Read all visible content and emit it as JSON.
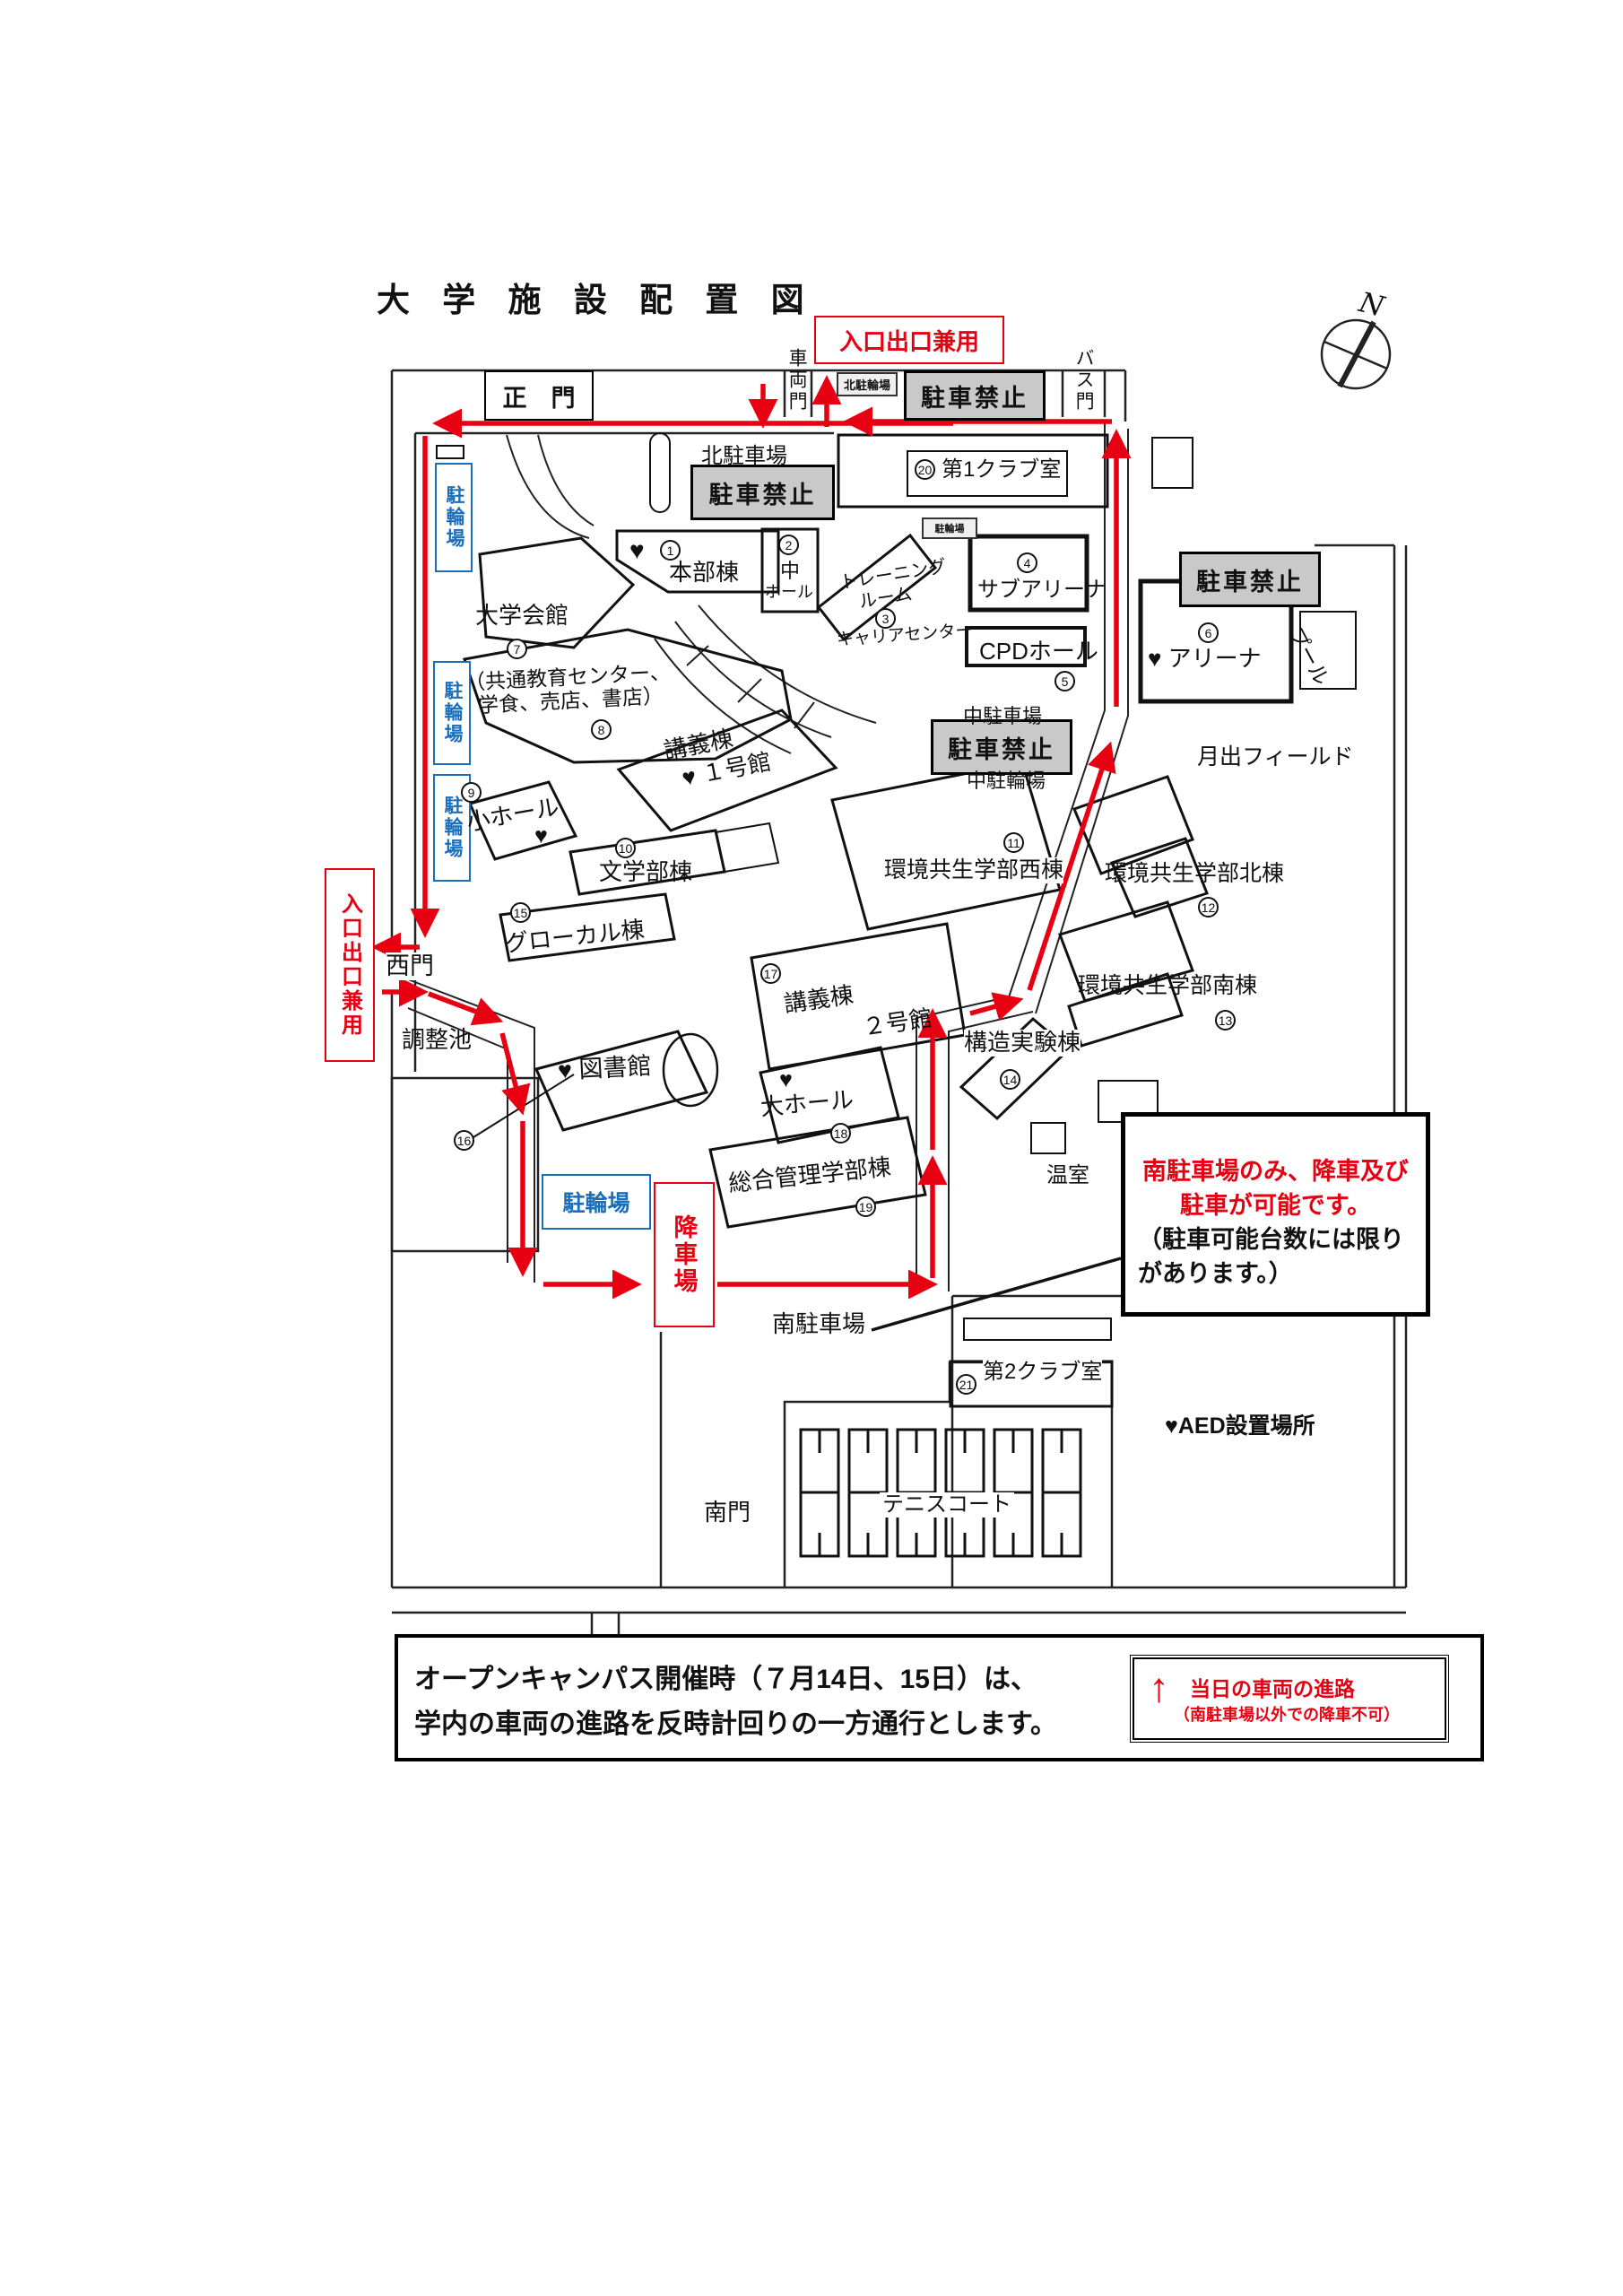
{
  "title": "大 学 施 設 配 置 図",
  "compass_label": "N",
  "gates": {
    "main": "正　門",
    "vehicle": "車両門",
    "bus": "バス門",
    "west": "西門",
    "south": "南門"
  },
  "signs": {
    "no_parking": "駐車禁止",
    "entry_exit": "入口出口兼用",
    "bike": "駐輪場",
    "bike_north": "北駐輪場",
    "drop_off": "降車場"
  },
  "areas": {
    "north_parking": "北駐車場",
    "mid_parking": "中駐車場",
    "mid_bike": "中駐輪場",
    "south_parking": "南駐車場",
    "tsukide_field": "月出フィールド",
    "pond": "調整池",
    "tennis": "テニスコート",
    "greenhouse": "温室",
    "pool": "プール"
  },
  "buildings": {
    "honbu": {
      "num": "1",
      "name": "本部棟",
      "heart": "♥"
    },
    "naka_hall": {
      "num": "2",
      "name_top": "中",
      "name_bottom": "ホール"
    },
    "training": {
      "num": "3",
      "line1": "トレーニング",
      "line2": "ルーム"
    },
    "sub_arena": {
      "num": "4",
      "name": "サブアリーナ"
    },
    "cpd": {
      "num": "5",
      "name": "CPDホール"
    },
    "career": {
      "name": "キャリアセンター"
    },
    "arena": {
      "num": "6",
      "name": "アリーナ",
      "heart": "♥"
    },
    "kaikan": {
      "num": "7",
      "name": "大学会館"
    },
    "kyotsu": {
      "num": "8",
      "line1": "（共通教育センター、",
      "line2": "学食、売店、書店）"
    },
    "sho_hall": {
      "num": "9",
      "name": "小ホール",
      "heart": "♥"
    },
    "bungaku": {
      "num": "10",
      "name": "文学部棟"
    },
    "kankyo_west": {
      "num": "11",
      "name": "環境共生学部西棟"
    },
    "kankyo_north": {
      "num": "12",
      "name": "環境共生学部北棟"
    },
    "kankyo_south": {
      "num": "13",
      "name": "環境共生学部南棟"
    },
    "kouzou": {
      "num": "14",
      "name": "構造実験棟"
    },
    "glocal": {
      "num": "15",
      "name": "グローカル棟"
    },
    "library": {
      "num": "16",
      "name": "図書館",
      "heart": "♥"
    },
    "kougi1": {
      "name": "講義棟",
      "sub": "１号館",
      "heart": "♥"
    },
    "kougi2": {
      "num": "17",
      "name": "講義棟",
      "sub": "２号館"
    },
    "dai_hall": {
      "num": "18",
      "name": "大ホール",
      "heart": "♥"
    },
    "sougou": {
      "num": "19",
      "name": "総合管理学部棟"
    },
    "club1": {
      "num": "20",
      "name": "第1クラブ室"
    },
    "club2": {
      "num": "21",
      "name": "第2クラブ室"
    }
  },
  "aed_note": "♥AED設置場所",
  "callout": {
    "red1": "南駐車場のみ、降車及び",
    "red2": "駐車が可能です。",
    "black1": "（駐車可能台数には限り",
    "black2": "があります。）"
  },
  "notice": {
    "line1": "オープンキャンパス開催時（７月14日、15日）は、",
    "line2": "学内の車両の進路を反時計回りの一方通行とします。",
    "legend_arrow": "↑",
    "legend_title": "当日の車両の進路",
    "legend_sub": "（南駐車場以外での降車不可）"
  }
}
